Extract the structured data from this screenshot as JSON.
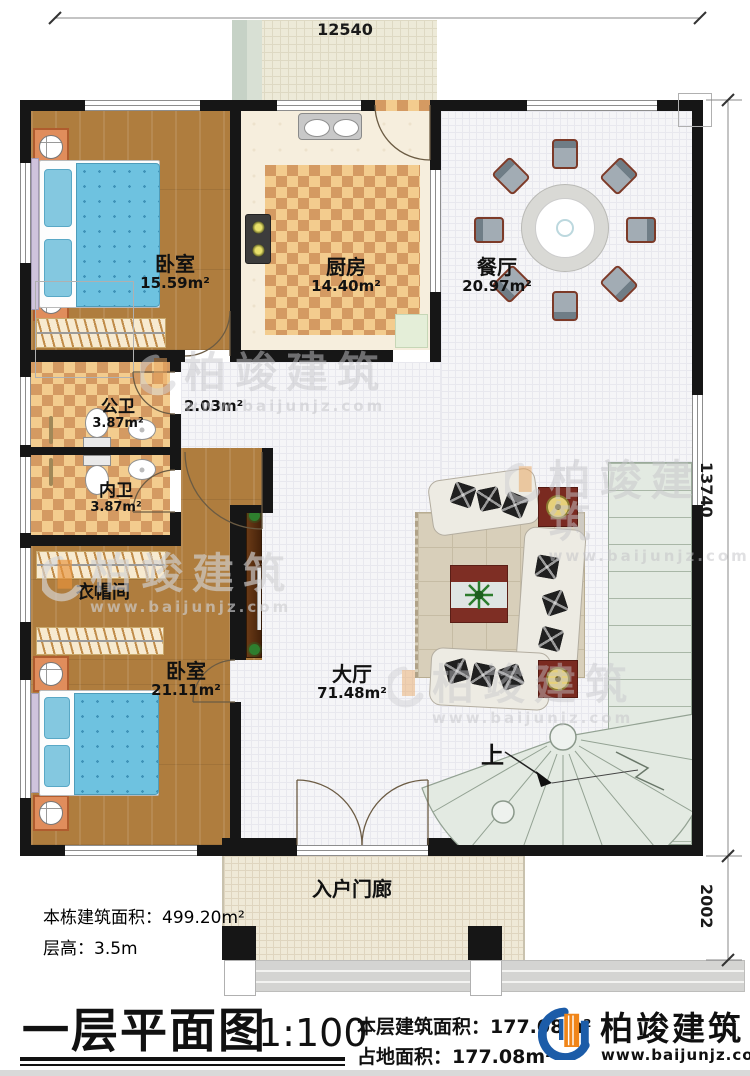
{
  "plan": {
    "dimensions": {
      "width_top": "12540",
      "height_right": "13740",
      "porch_depth": "2002"
    },
    "rooms": {
      "bedroom_top": {
        "name": "卧室",
        "area": "15.59m²"
      },
      "kitchen": {
        "name": "厨房",
        "area": "14.40m²"
      },
      "dining": {
        "name": "餐厅",
        "area": "20.97m²"
      },
      "public_bath": {
        "name": "公卫",
        "area": "3.87m²"
      },
      "private_bath": {
        "name": "内卫",
        "area": "3.87m²"
      },
      "corridor_area_label": "2.03m²",
      "cloakroom": {
        "name": "衣帽间"
      },
      "bedroom_bottom": {
        "name": "卧室",
        "area": "21.11m²"
      },
      "hall": {
        "name": "大厅",
        "area": "71.48m²"
      },
      "porch": {
        "name": "入户门廊"
      }
    },
    "stairs_up_label": "上"
  },
  "info_block": {
    "building_total_area": "本栋建筑面积：499.20m²",
    "floor_height": "层高：3.5m"
  },
  "title_block": {
    "title": "一层平面图",
    "scale": "1:100",
    "floor_area": "本层建筑面积：177.08m²",
    "footprint_area": "占地面积：177.08m²"
  },
  "brand": {
    "name": "柏竣建筑",
    "site": "www.baijunjz.com"
  },
  "watermark": {
    "name": "柏竣建筑",
    "site": "www.baijunjz.com"
  },
  "colors": {
    "wall": "#161616",
    "wood_floor": "#af7d3e",
    "tile_light": "#f3cc8e",
    "tile_dark": "#d49a62",
    "stair": "#e3eae2",
    "hall_floor": "#f5f5f7",
    "brand_blue": "#1c5ca8",
    "brand_orange": "#f08519",
    "bed": "#6ec2e0"
  }
}
